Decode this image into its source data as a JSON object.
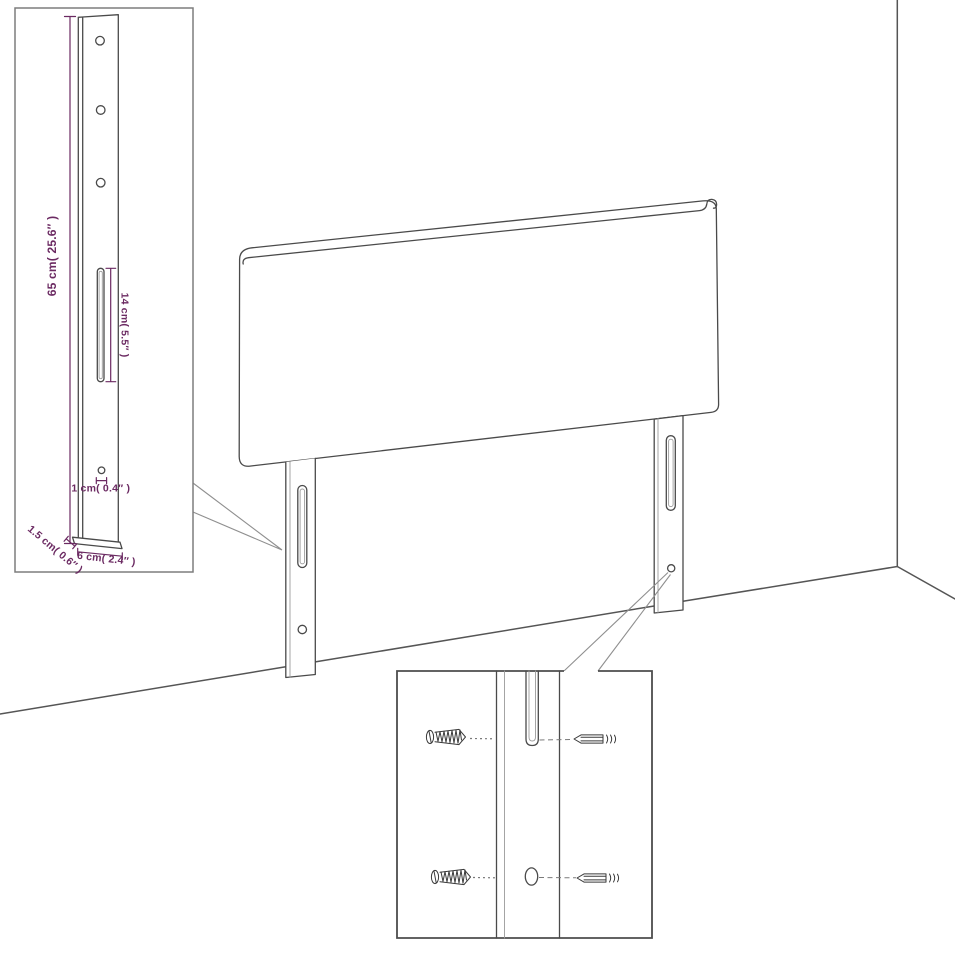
{
  "diagram": {
    "title": "Headboard with legs — dimension diagram",
    "labels": {
      "leg_height": "65 cm( 25.6″ )",
      "slot_length": "14 cm( 5.5″ )",
      "hole_diameter": "1 cm( 0.4″ )",
      "leg_thickness": "1.5 cm( 0.6″ )",
      "leg_width": "6 cm( 2.4″ )"
    },
    "colors": {
      "dimension_text": "#6B2A62",
      "line": "#4A4A4A",
      "background": "#FFFFFF"
    }
  }
}
